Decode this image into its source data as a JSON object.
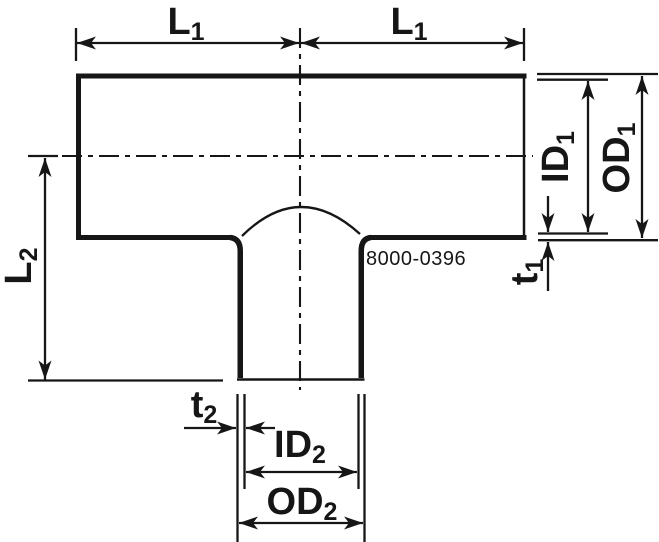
{
  "drawing": {
    "part_number": "8000-0396",
    "labels": {
      "l1_left": {
        "base": "L",
        "sub": "1"
      },
      "l1_right": {
        "base": "L",
        "sub": "1"
      },
      "l2": {
        "base": "L",
        "sub": "2"
      },
      "id1": {
        "base": "ID",
        "sub": "1"
      },
      "od1": {
        "base": "OD",
        "sub": "1"
      },
      "t1": {
        "base": "t",
        "sub": "1"
      },
      "t2": {
        "base": "t",
        "sub": "2"
      },
      "id2": {
        "base": "ID",
        "sub": "2"
      },
      "od2": {
        "base": "OD",
        "sub": "2"
      }
    },
    "colors": {
      "ink": "#161616",
      "background": "#ffffff"
    }
  }
}
